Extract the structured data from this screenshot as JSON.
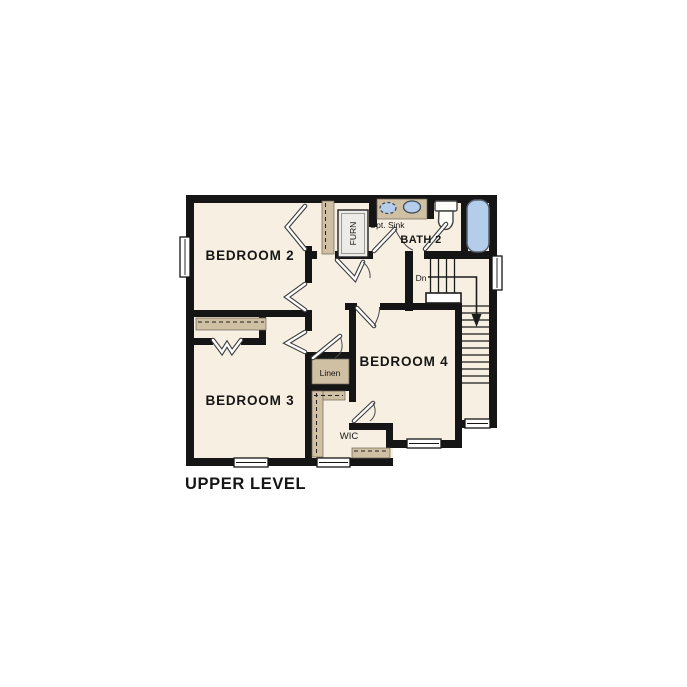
{
  "title": {
    "label": "UPPER LEVEL"
  },
  "rooms": {
    "bedroom2": "BEDROOM 2",
    "bedroom3": "BEDROOM 3",
    "bedroom4": "BEDROOM 4",
    "bath2": "BATH 2",
    "wic": "WIC",
    "linen": "Linen",
    "furnace": "FURN",
    "opt_sink": "Opt. Sink",
    "stairs_down": "Dn"
  },
  "colors": {
    "background": "#ffffff",
    "floor": "#f7efe2",
    "wall": "#151515",
    "casework": "#cfc0a4",
    "fixture_blue": "#b3cdea"
  }
}
